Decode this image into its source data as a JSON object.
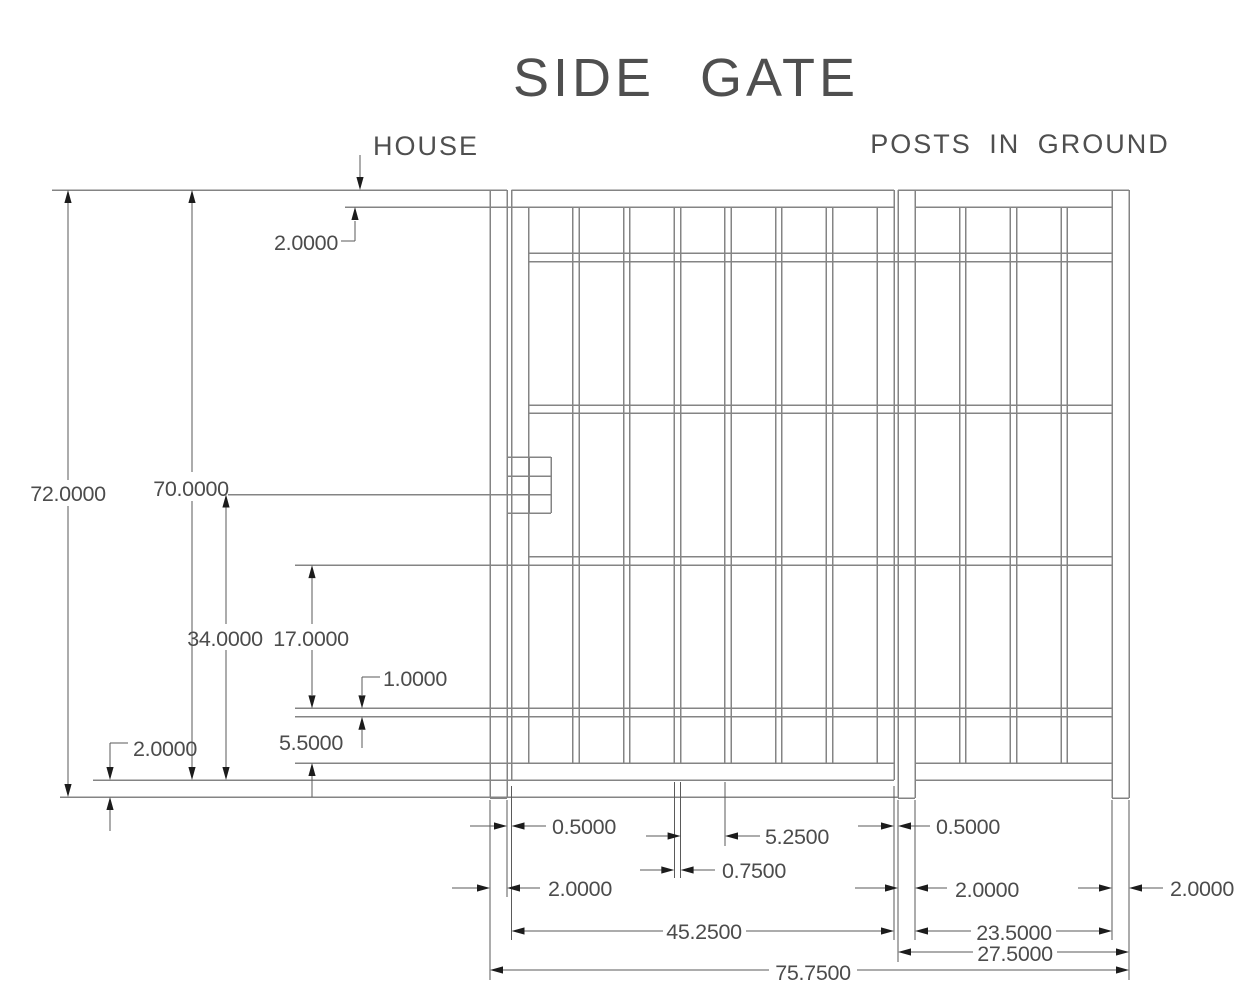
{
  "title": "SIDE GATE",
  "labels": {
    "house": "HOUSE",
    "posts_in_ground": "POSTS IN GROUND"
  },
  "dims": {
    "overall_height": "72.0000",
    "gate_height": "70.0000",
    "top_rail": "2.0000",
    "hinge_to_bottom": "34.0000",
    "rail_gap": "17.0000",
    "rail_thickness": "1.0000",
    "bottom_gap": "5.5000",
    "ground_clearance": "2.0000",
    "hinge_gap": "0.5000",
    "hinge_post": "2.0000",
    "bar_gap": "5.2500",
    "bar_width": "0.7500",
    "gate_width": "45.2500",
    "overall_width": "75.7500",
    "latch_gap": "0.5000",
    "latch_post": "2.0000",
    "panel_inner": "23.5000",
    "panel_outer": "27.5000",
    "end_post": "2.0000"
  },
  "structure": {
    "gate_bar_count": 6,
    "panel_bar_count": 3,
    "intermediate_rail_count": 4,
    "post_count": 3
  },
  "colors": {
    "structure_line": "#848484",
    "dimension_line": "#5a5a5a",
    "arrow": "#1c1c1c",
    "text": "#4c4c4c",
    "background": "#ffffff"
  }
}
